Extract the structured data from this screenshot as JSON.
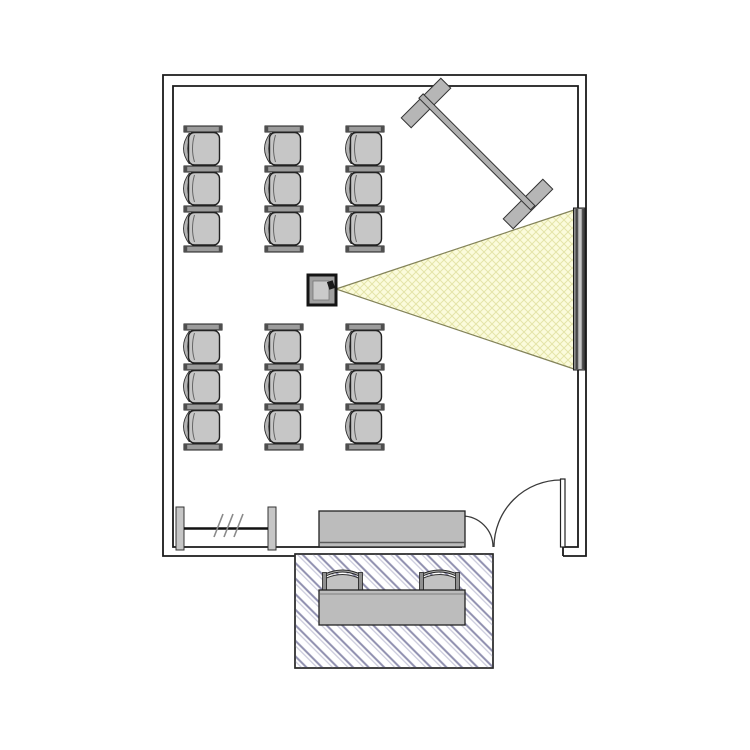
{
  "colors": {
    "wall": "#1a1a1a",
    "line": "#3a3a3a",
    "furn": "#bcbcbc",
    "barfill": "#9c9c9c",
    "seat": "#c6c6c6",
    "seatback": "#b4b4b4",
    "pfoot": "#b6b6b6",
    "beamFill": "#fbfbdc",
    "beamGrid": "#e4e4a8",
    "beamEdge": "#83835a",
    "screenDark": "#454545",
    "screenMid": "#8e8e8e",
    "screenLight": "#c6c6c6",
    "hatchDark": "#8e8eae",
    "hatchLight": "#c8c8da",
    "projectorBody": "#a0a0a0",
    "projectorInner": "#cacaca"
  },
  "floor_plan": {
    "room": "screening-room",
    "seating": {
      "groups": [
        {
          "x": 178,
          "y": 126
        },
        {
          "x": 178,
          "y": 324
        }
      ],
      "column_offsets": [
        0,
        81,
        162
      ],
      "seats_per_column": 3,
      "total_seats": 18
    },
    "waiting_area": {
      "chair_x": [
        322,
        419
      ],
      "chair_y": 565,
      "chair_count": 2
    },
    "objects": [
      {
        "name": "projector"
      },
      {
        "name": "projection-beam"
      },
      {
        "name": "projection-screen"
      },
      {
        "name": "mobile-partition"
      },
      {
        "name": "coat-rack"
      },
      {
        "name": "sideboard"
      },
      {
        "name": "door"
      },
      {
        "name": "entry-mat"
      },
      {
        "name": "waiting-table"
      }
    ]
  }
}
